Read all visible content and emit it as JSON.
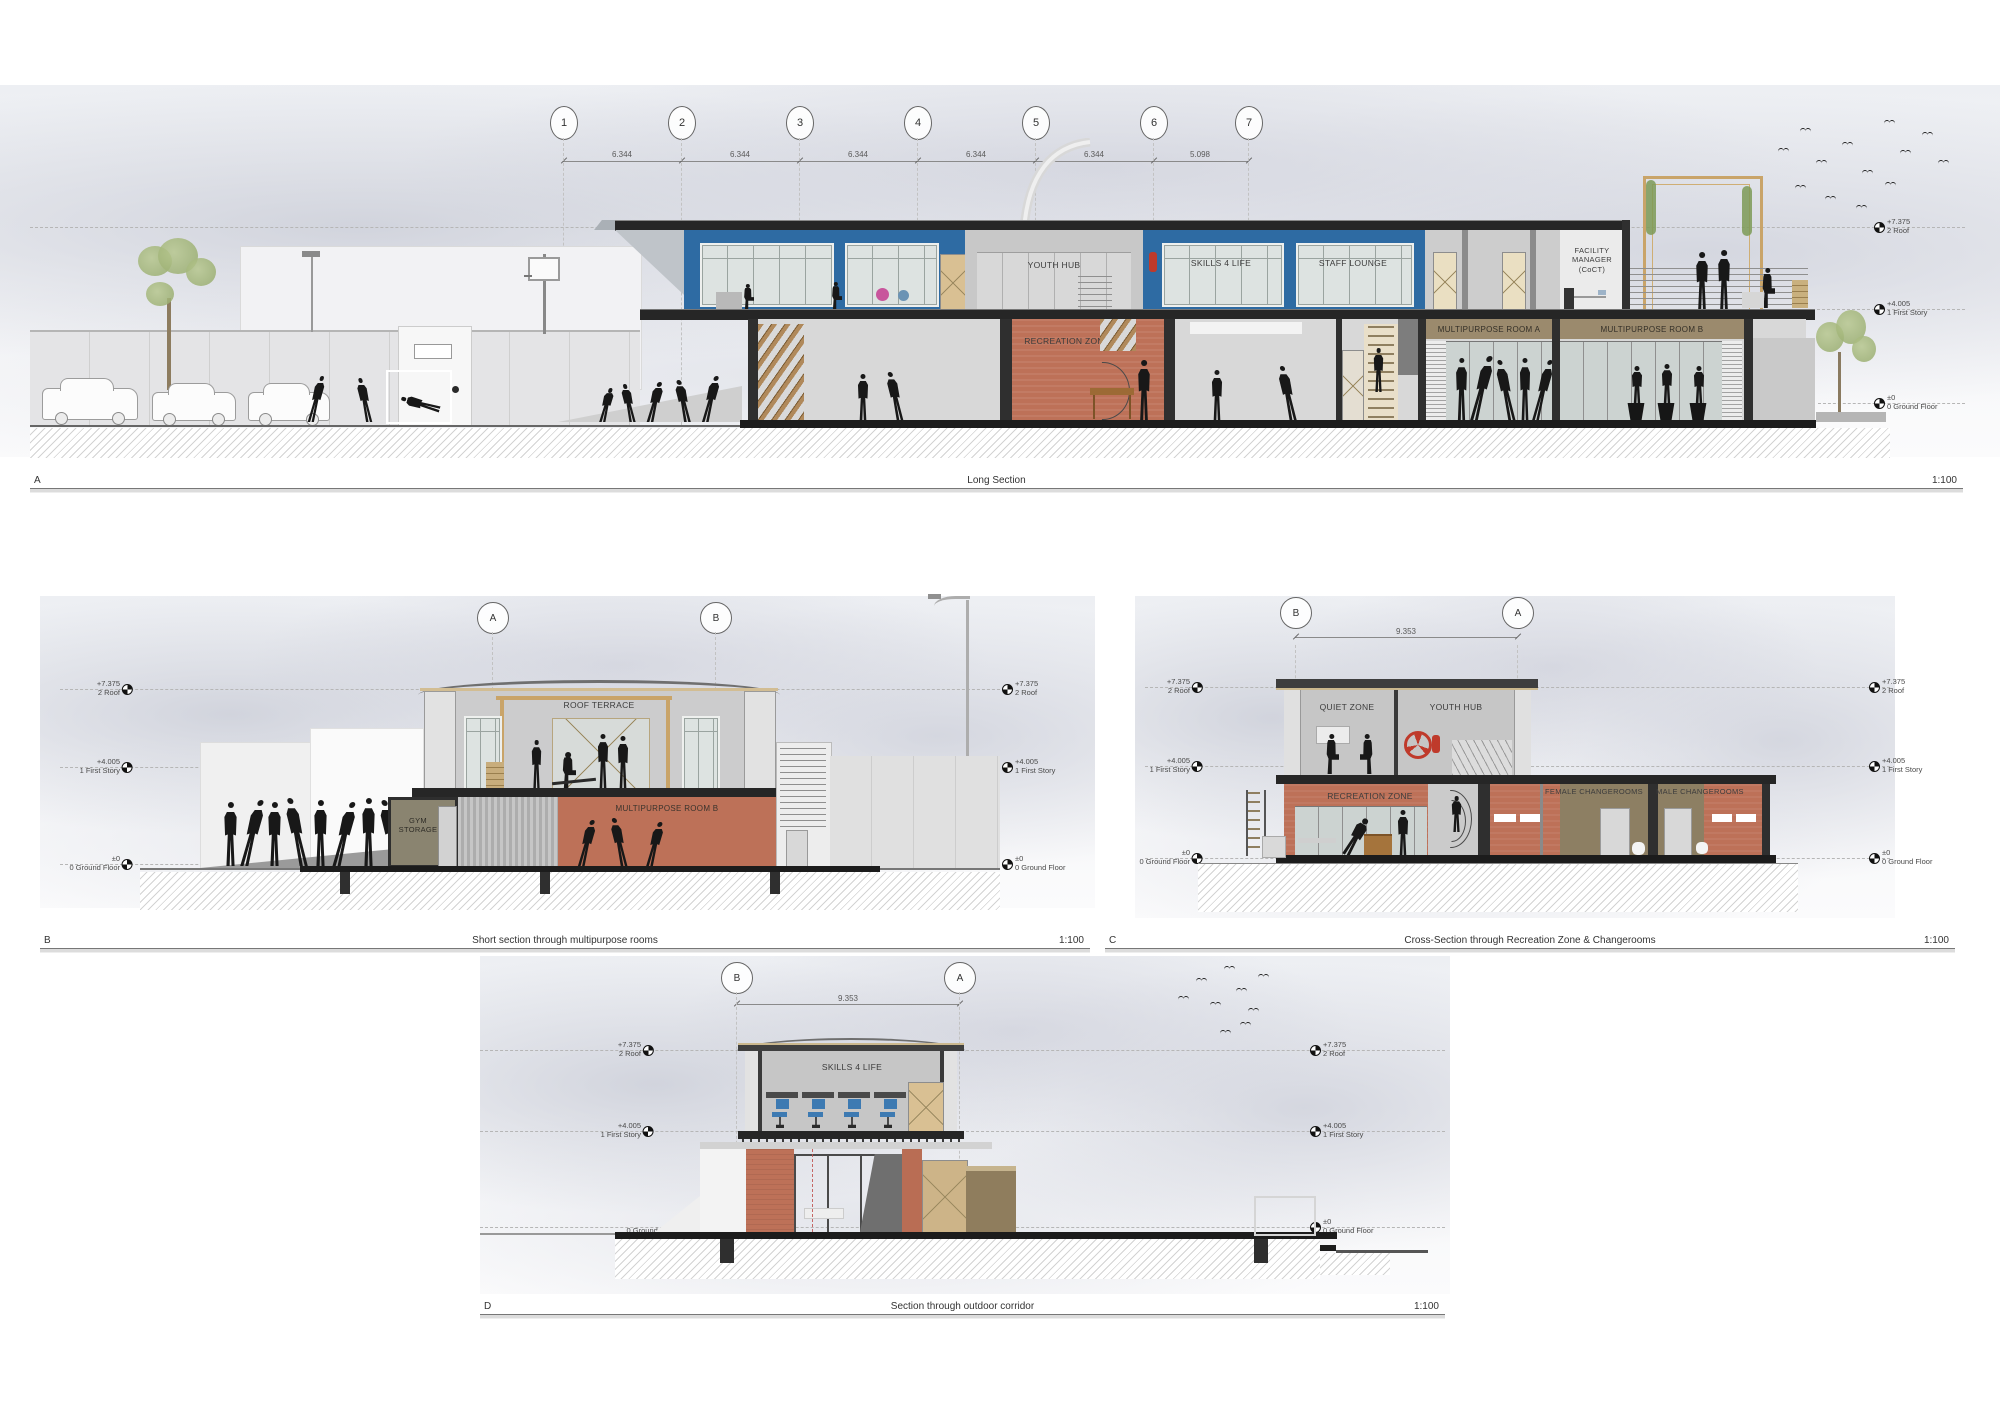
{
  "drawing": {
    "levels": {
      "roof": {
        "elev": "+7.375",
        "name": "2 Roof"
      },
      "first": {
        "elev": "+4.005",
        "name": "1 First Story"
      },
      "ground": {
        "elev": "±0",
        "name": "0 Ground Floor"
      }
    },
    "sections": {
      "a": {
        "letter": "A",
        "title": "Long Section",
        "scale": "1:100",
        "grid": [
          "1",
          "2",
          "3",
          "4",
          "5",
          "6",
          "7"
        ],
        "dims": [
          "6.344",
          "6.344",
          "6.344",
          "6.344",
          "6.344",
          "5.098"
        ],
        "rooms": {
          "youth_hub": "YOUTH HUB",
          "skills": "SKILLS 4 LIFE",
          "staff_lounge": "STAFF LOUNGE",
          "facility_manager": "FACILITY MANAGER (CoCT)",
          "recreation": "RECREATION ZONE",
          "mp_a": "MULTIPURPOSE ROOM A",
          "mp_b": "MULTIPURPOSE ROOM B"
        }
      },
      "b": {
        "letter": "B",
        "title": "Short section through multipurpose rooms",
        "scale": "1:100",
        "grid": [
          "A",
          "B"
        ],
        "rooms": {
          "roof_terrace": "ROOF TERRACE",
          "mp_b": "MULTIPURPOSE ROOM B",
          "gym_storage": "GYM STORAGE"
        }
      },
      "c": {
        "letter": "C",
        "title": "Cross-Section through Recreation Zone & Changerooms",
        "scale": "1:100",
        "grid": [
          "B",
          "A"
        ],
        "dim": "9.353",
        "rooms": {
          "quiet": "QUIET ZONE",
          "youth_hub": "YOUTH HUB",
          "recreation": "RECREATION ZONE",
          "female": "FEMALE CHANGEROOMS",
          "male": "MALE CHANGEROOMS"
        }
      },
      "d": {
        "letter": "D",
        "title": "Section through outdoor corridor",
        "scale": "1:100",
        "grid": [
          "B",
          "A"
        ],
        "dim": "9.353",
        "rooms": {
          "skills": "SKILLS 4 LIFE"
        }
      }
    }
  },
  "colors": {
    "blue_panel": "#2e6ba3",
    "terracotta": "#bd7158",
    "brown_band": "#9b8a6d",
    "olive": "#8a8470",
    "slab": "#262626",
    "wood_tan": "#c9a469",
    "door_tan": "#d9c093",
    "glass": "#ccd3d1",
    "red_equipment": "#bf3a2b"
  }
}
